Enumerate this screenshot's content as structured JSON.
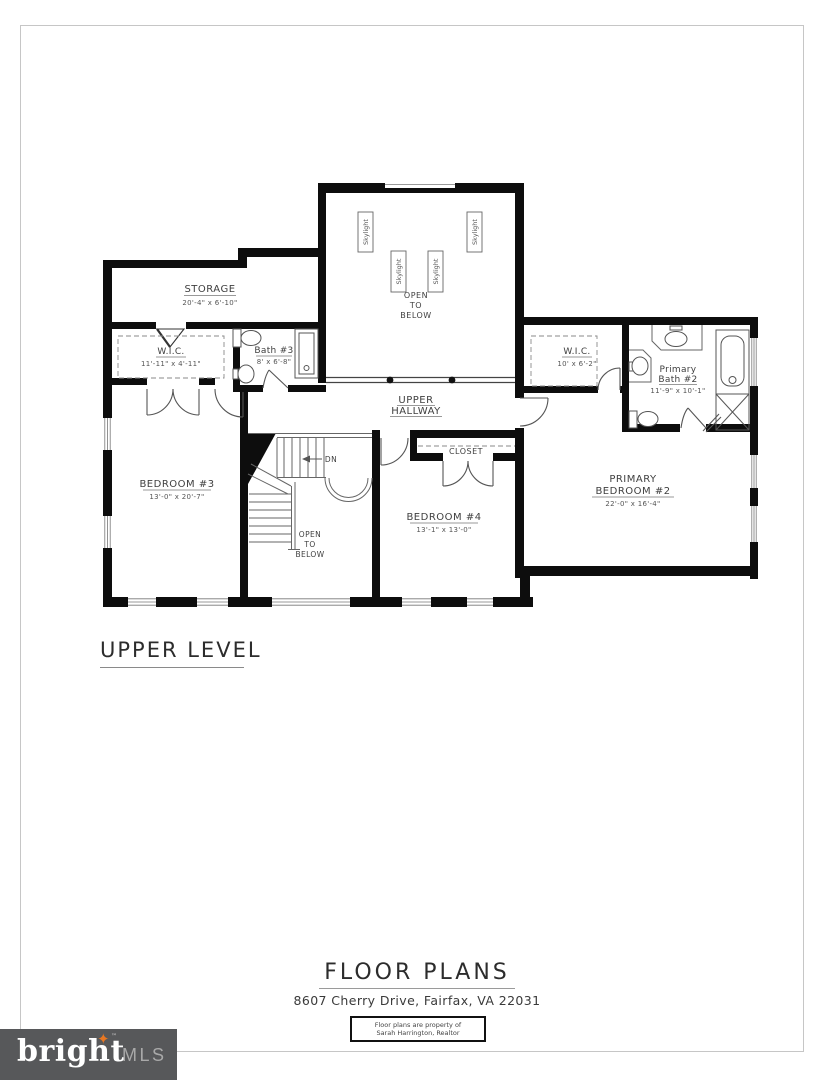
{
  "page": {
    "level_label": "UPPER LEVEL",
    "footer": {
      "title": "FLOOR PLANS",
      "address": "8607 Cherry Drive, Fairfax, VA  22031",
      "disclaimer_line1": "Floor plans are property of",
      "disclaimer_line2": "Sarah Harrington, Realtor"
    },
    "logo": {
      "brand": "bright",
      "sparkle": "✦",
      "tm": "™",
      "suffix": "MLS",
      "bg_color": "#57585A",
      "accent_color": "#E87722",
      "mls_color": "#A9A9A9"
    }
  },
  "plan": {
    "storage": {
      "name": "STORAGE",
      "dims": "20'-4\" x 6'-10\""
    },
    "wic_left": {
      "name": "W.I.C.",
      "dims": "11'-11\" x 4'-11\""
    },
    "bath3": {
      "name": "Bath #3",
      "dims": "8' x 6'-8\""
    },
    "open_to_below_upper": {
      "line1": "OPEN",
      "line2": "TO",
      "line3": "BELOW"
    },
    "skylight_label": "Skylight",
    "wic_right": {
      "name": "W.I.C.",
      "dims": "10' x 6'-2\""
    },
    "primary_bath": {
      "name_line1": "Primary",
      "name_line2": "Bath #2",
      "dims": "11'-9\" x 10'-1\""
    },
    "hallway": {
      "line1": "UPPER",
      "line2": "HALLWAY"
    },
    "bedroom3": {
      "name": "BEDROOM #3",
      "dims": "13'-0\" x 20'-7\""
    },
    "bedroom4": {
      "name": "BEDROOM #4",
      "dims": "13'-1\" x 13'-0\""
    },
    "closet": {
      "name": "CLOSET"
    },
    "primary_bedroom": {
      "name_line1": "PRIMARY",
      "name_line2": "BEDROOM #2",
      "dims": "22'-0\" x 16'-4\""
    },
    "stairs": {
      "down_label": "DN",
      "open1": "OPEN",
      "open2": "TO",
      "open3": "BELOW"
    }
  }
}
